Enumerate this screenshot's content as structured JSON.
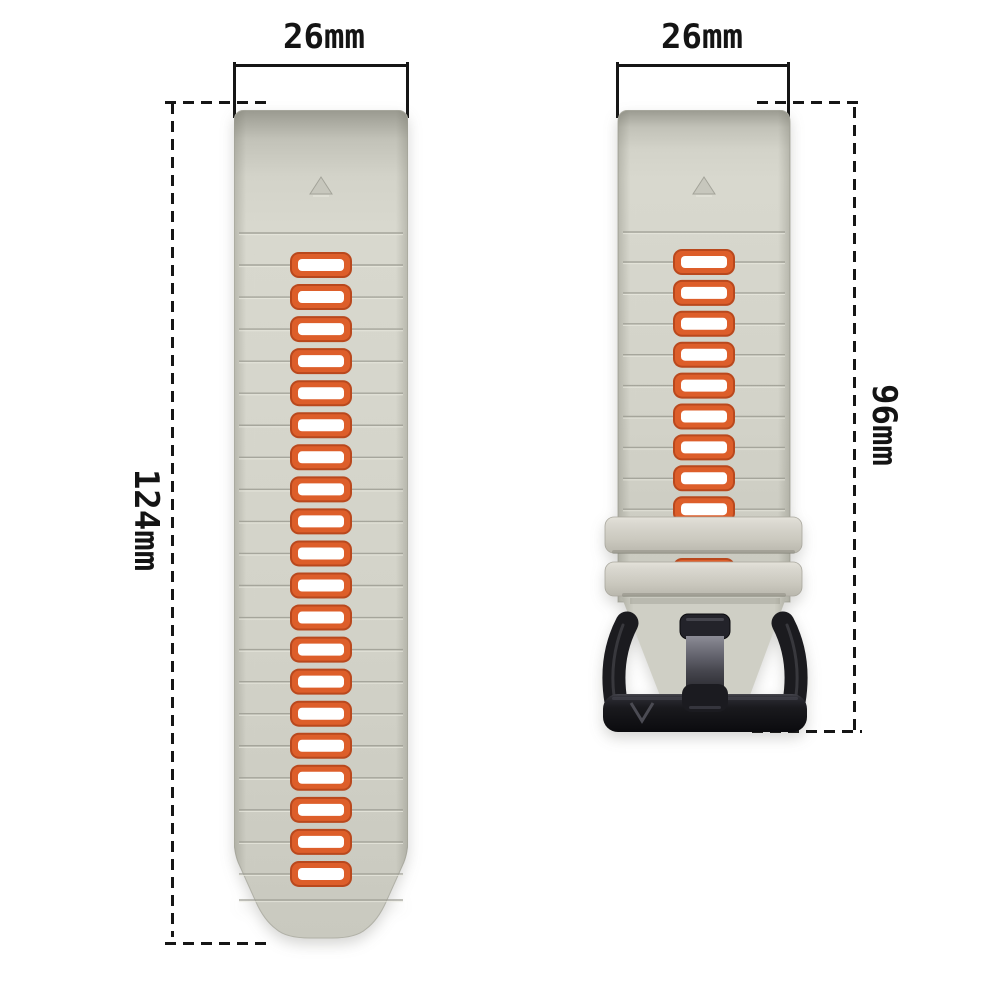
{
  "page": {
    "background": "#ffffff",
    "annotation_line_color": "#161616"
  },
  "annotations": {
    "left_width_label": "26mm",
    "right_width_label": "26mm",
    "left_length_label": "124mm",
    "right_length_label": "96mm"
  },
  "product": {
    "strap_color": "#d4d4ca",
    "strap_edge_color": "#a8a89e",
    "hole_ring_color": "#dd5e2a",
    "hole_rim_color": "#b9481d",
    "hole_center_color": "#ffffff",
    "buckle_color": "#1b1b1f",
    "buckle_logo": "V",
    "left_strap": {
      "holes": 20,
      "triangle_marker": true
    },
    "right_strap": {
      "holes": 11,
      "keepers": 2,
      "triangle_marker": true
    }
  }
}
